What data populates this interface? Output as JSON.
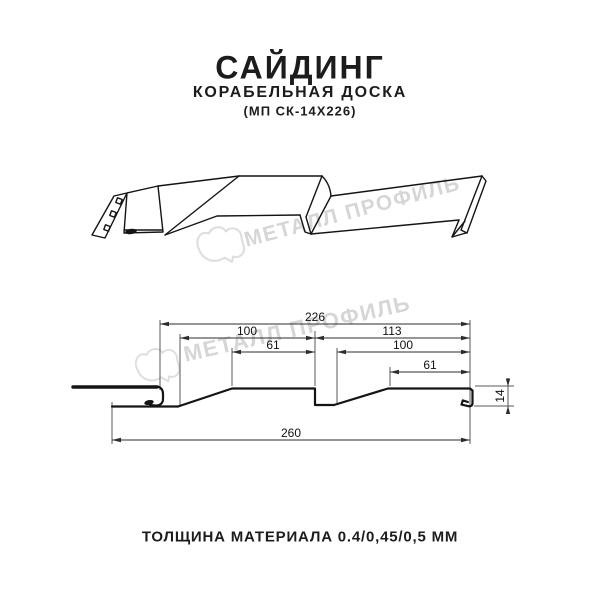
{
  "header": {
    "title": "САЙДИНГ",
    "subtitle": "КОРАБЕЛЬНАЯ ДОСКА",
    "model_code": "(МП СК-14Х226)"
  },
  "watermark": {
    "brand": "МЕТАЛЛ ПРОФИЛЬ",
    "color": "#d6d6d6"
  },
  "cross_section": {
    "dim_module_width": "226",
    "dim_left_board_width": "100",
    "dim_right_pitch": "113",
    "dim_left_flat": "61",
    "dim_right_board_width": "100",
    "dim_right_flat": "61",
    "dim_total_width": "260",
    "dim_profile_height": "14"
  },
  "footer": {
    "material_thickness": "ТОЛЩИНА МАТЕРИАЛА 0.4/0,45/0,5 ММ"
  },
  "colors": {
    "line": "#141414",
    "dimension_line": "#2e2e2e"
  }
}
